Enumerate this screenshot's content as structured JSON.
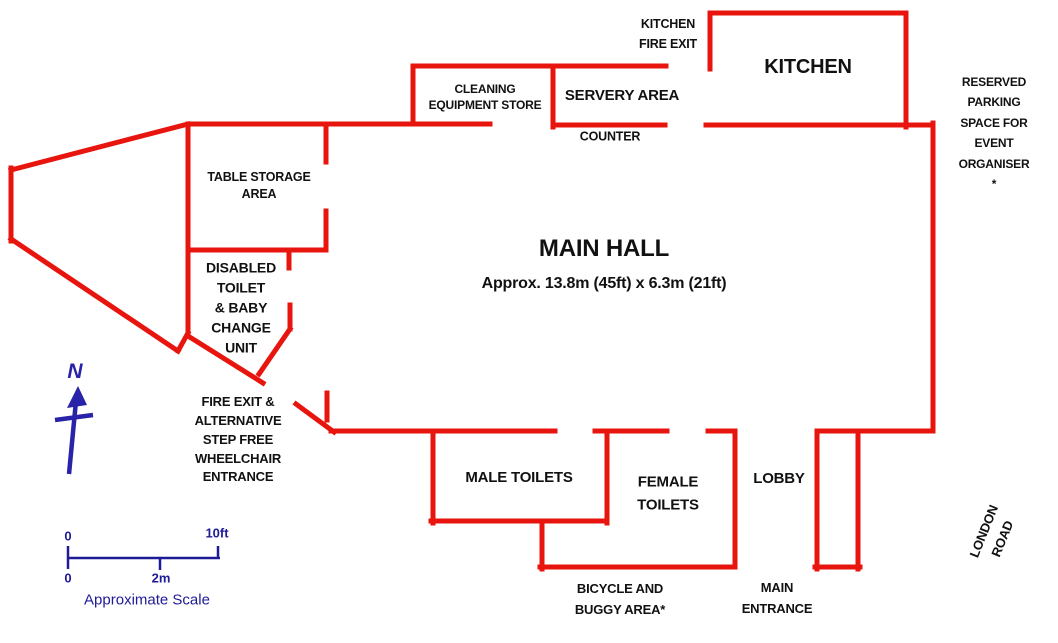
{
  "diagram": {
    "type": "floor-plan",
    "background": "#ffffff",
    "wall_color": "#e8140e",
    "text_color": "#111111",
    "compass_color": "#2823a8",
    "scale_color": "#1e1b96"
  },
  "labels": [
    {
      "id": "kitchen-fire-exit",
      "text": "KITCHEN\nFIRE EXIT",
      "x": 668,
      "y": 34,
      "size": 12.5
    },
    {
      "id": "kitchen-room",
      "text": "KITCHEN",
      "x": 808,
      "y": 67,
      "size": 20
    },
    {
      "id": "cleaning-equipment-store",
      "text": "CLEANING\nEQUIPMENT STORE",
      "x": 485,
      "y": 97,
      "size": 12
    },
    {
      "id": "servery-area",
      "text": "SERVERY AREA",
      "x": 622,
      "y": 96,
      "size": 15
    },
    {
      "id": "counter",
      "text": "COUNTER",
      "x": 610,
      "y": 137,
      "size": 12.5
    },
    {
      "id": "reserved-parking",
      "text": "RESERVED\nPARKING\nSPACE FOR\nEVENT\nORGANISER *",
      "x": 994,
      "y": 133,
      "size": 12
    },
    {
      "id": "table-storage-area",
      "text": "TABLE STORAGE\nAREA",
      "x": 259,
      "y": 186,
      "size": 12.5
    },
    {
      "id": "main-hall",
      "text": "MAIN HALL",
      "x": 604,
      "y": 249,
      "size": 24
    },
    {
      "id": "main-hall-dimensions",
      "text": "Approx.  13.8m (45ft) x 6.3m (21ft)",
      "x": 604,
      "y": 284,
      "size": 16
    },
    {
      "id": "disabled-toilet",
      "text": "DISABLED\nTOILET\n& BABY\nCHANGE\nUNIT",
      "x": 241,
      "y": 308,
      "size": 14
    },
    {
      "id": "fire-exit",
      "text": "FIRE EXIT &\nALTERNATIVE\nSTEP FREE\nWHEELCHAIR\nENTRANCE",
      "x": 238,
      "y": 440,
      "size": 13
    },
    {
      "id": "male-toilets",
      "text": "MALE TOILETS",
      "x": 519,
      "y": 478,
      "size": 15
    },
    {
      "id": "female-toilets",
      "text": "FEMALE\nTOILETS",
      "x": 668,
      "y": 494,
      "size": 15
    },
    {
      "id": "lobby",
      "text": "LOBBY",
      "x": 779,
      "y": 479,
      "size": 15
    },
    {
      "id": "bicycle-buggy-area",
      "text": "BICYCLE AND\nBUGGY AREA*",
      "x": 620,
      "y": 600,
      "size": 13
    },
    {
      "id": "main-entrance",
      "text": "MAIN\nENTRANCE",
      "x": 777,
      "y": 599,
      "size": 13
    },
    {
      "id": "london-road",
      "text": "LONDON ROAD",
      "x": 993,
      "y": 535,
      "size": 13,
      "rotation": -68
    }
  ],
  "walls": {
    "thickness": 5,
    "segments": [
      [
        188,
        124,
        11,
        170
      ],
      [
        11,
        168,
        11,
        241
      ],
      [
        11,
        239,
        178,
        351
      ],
      [
        178,
        351,
        188,
        333
      ],
      [
        188,
        124,
        188,
        334
      ],
      [
        188,
        124,
        490,
        124
      ],
      [
        326,
        124,
        326,
        162
      ],
      [
        326,
        211,
        326,
        250
      ],
      [
        188,
        250,
        326,
        250
      ],
      [
        289,
        250,
        289,
        268
      ],
      [
        188,
        336,
        263,
        383
      ],
      [
        290,
        305,
        290,
        329
      ],
      [
        290,
        329,
        259,
        374
      ],
      [
        296,
        404,
        334,
        432
      ],
      [
        327,
        393,
        327,
        420
      ],
      [
        413,
        66,
        666,
        66
      ],
      [
        413,
        66,
        413,
        124
      ],
      [
        553,
        66,
        553,
        127
      ],
      [
        553,
        125,
        665,
        125
      ],
      [
        710,
        13,
        906,
        13
      ],
      [
        710,
        13,
        710,
        69
      ],
      [
        906,
        13,
        906,
        127
      ],
      [
        706,
        125,
        933,
        125
      ],
      [
        933,
        123,
        933,
        431
      ],
      [
        331,
        431,
        555,
        431
      ],
      [
        595,
        431,
        667,
        431
      ],
      [
        708,
        431,
        734,
        431
      ],
      [
        817,
        431,
        933,
        431
      ],
      [
        433,
        431,
        433,
        523
      ],
      [
        431,
        521,
        607,
        521
      ],
      [
        607,
        431,
        607,
        523
      ],
      [
        542,
        521,
        542,
        569
      ],
      [
        540,
        567,
        735,
        567
      ],
      [
        735,
        431,
        735,
        567
      ],
      [
        817,
        431,
        817,
        569
      ],
      [
        858,
        431,
        858,
        569
      ],
      [
        815,
        567,
        860,
        567
      ]
    ]
  },
  "compass": {
    "label": "N"
  },
  "scale_bar": {
    "imperial_zero": "0",
    "imperial_max": "10ft",
    "metric_zero": "0",
    "metric_max": "2m",
    "caption": "Approximate Scale"
  }
}
